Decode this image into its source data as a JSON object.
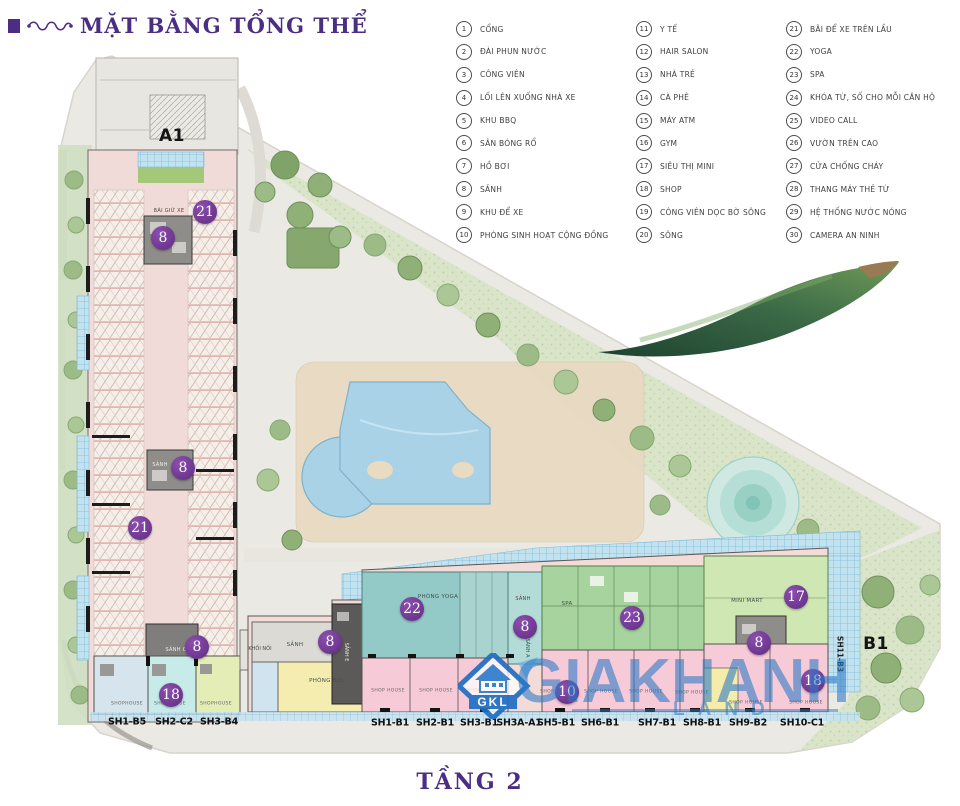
{
  "title": "MẶT BẰNG TỔNG THỂ",
  "floor_label": "TẦNG 2",
  "legend": {
    "columns": [
      {
        "items": [
          {
            "num": "1",
            "label": "CỔNG"
          },
          {
            "num": "2",
            "label": "ĐÀI PHUN NƯỚC"
          },
          {
            "num": "3",
            "label": "CÔNG VIÊN"
          },
          {
            "num": "4",
            "label": "LỐI LÊN XUỐNG NHÀ XE"
          },
          {
            "num": "5",
            "label": "KHU BBQ"
          },
          {
            "num": "6",
            "label": "SÂN BÓNG RỔ"
          },
          {
            "num": "7",
            "label": "HỒ BƠI"
          },
          {
            "num": "8",
            "label": "SẢNH"
          },
          {
            "num": "9",
            "label": "KHU ĐỂ XE"
          },
          {
            "num": "10",
            "label": "PHÒNG SINH HOẠT CỘNG ĐỒNG"
          }
        ]
      },
      {
        "items": [
          {
            "num": "11",
            "label": "Y TẾ"
          },
          {
            "num": "12",
            "label": "HAIR SALON"
          },
          {
            "num": "13",
            "label": "NHÀ TRẺ"
          },
          {
            "num": "14",
            "label": "CÀ PHÊ"
          },
          {
            "num": "15",
            "label": "MÁY ATM"
          },
          {
            "num": "16",
            "label": "GYM"
          },
          {
            "num": "17",
            "label": "SIÊU THỊ MINI"
          },
          {
            "num": "18",
            "label": "SHOP"
          },
          {
            "num": "19",
            "label": "CÔNG VIÊN DỌC BỜ SÔNG"
          },
          {
            "num": "20",
            "label": "SÔNG"
          }
        ]
      },
      {
        "items": [
          {
            "num": "21",
            "label": "BÃI ĐỂ XE TRÊN LẦU"
          },
          {
            "num": "22",
            "label": "YOGA"
          },
          {
            "num": "23",
            "label": "SPA"
          },
          {
            "num": "24",
            "label": "KHÓA TỪ, SỐ CHO MỖI CĂN HỘ"
          },
          {
            "num": "25",
            "label": "VIDEO CALL"
          },
          {
            "num": "26",
            "label": "VƯỜN TRÊN CAO"
          },
          {
            "num": "27",
            "label": "CỬA CHỐNG CHÁY"
          },
          {
            "num": "28",
            "label": "THANG MÁY THẺ TỪ"
          },
          {
            "num": "29",
            "label": "HỆ THỐNG NƯỚC NÓNG"
          },
          {
            "num": "30",
            "label": "CAMERA AN NINH"
          }
        ]
      }
    ]
  },
  "plan": {
    "building_labels": [
      {
        "text": "A1",
        "x": 172,
        "y": 136
      },
      {
        "text": "B1",
        "x": 876,
        "y": 644
      }
    ],
    "badges": [
      {
        "num": "21",
        "x": 205,
        "y": 212
      },
      {
        "num": "8",
        "x": 163,
        "y": 238
      },
      {
        "num": "8",
        "x": 183,
        "y": 468
      },
      {
        "num": "21",
        "x": 140,
        "y": 528
      },
      {
        "num": "8",
        "x": 197,
        "y": 647
      },
      {
        "num": "18",
        "x": 171,
        "y": 695
      },
      {
        "num": "22",
        "x": 412,
        "y": 609
      },
      {
        "num": "8",
        "x": 330,
        "y": 642
      },
      {
        "num": "8",
        "x": 525,
        "y": 627
      },
      {
        "num": "23",
        "x": 632,
        "y": 618
      },
      {
        "num": "10",
        "x": 567,
        "y": 692
      },
      {
        "num": "17",
        "x": 796,
        "y": 597
      },
      {
        "num": "8",
        "x": 759,
        "y": 643
      },
      {
        "num": "18",
        "x": 813,
        "y": 681
      }
    ],
    "room_labels": [
      {
        "text": "BÃI GIỮ XE",
        "x": 169,
        "y": 211,
        "style": "rl-d5"
      },
      {
        "text": "SẢNH",
        "x": 160,
        "y": 465,
        "style": "rl-w"
      },
      {
        "text": "SẢNH C",
        "x": 176,
        "y": 650,
        "style": "rl-w"
      },
      {
        "text": "KHỐI NỐI",
        "x": 260,
        "y": 649,
        "style": "rl-wrap"
      },
      {
        "text": "SẢNH",
        "x": 295,
        "y": 645,
        "style": "rl-d6"
      },
      {
        "text": "PHÒNG BQL",
        "x": 327,
        "y": 681,
        "style": "rl-d6"
      },
      {
        "text": "PHÒNG YOGA",
        "x": 438,
        "y": 597,
        "style": "rl-d6"
      },
      {
        "text": "SẢNH",
        "x": 523,
        "y": 599,
        "style": "rl-d5"
      },
      {
        "text": "SPA",
        "x": 567,
        "y": 604,
        "style": "rl-d6"
      },
      {
        "text": "MINI MART",
        "x": 747,
        "y": 601,
        "style": "rl-d6"
      }
    ],
    "vertical_labels": [
      {
        "text": "SẢNH E",
        "x": 346,
        "y": 652,
        "style": "vl-w"
      },
      {
        "text": "SẢNH A",
        "x": 527,
        "y": 648,
        "style": "vl-d"
      },
      {
        "text": "SH11-B3",
        "x": 840,
        "y": 654,
        "style": "vl-b"
      }
    ],
    "unit_labels": [
      {
        "text": "SH1-B5",
        "x": 127,
        "y": 722
      },
      {
        "text": "SH2-C2",
        "x": 174,
        "y": 722
      },
      {
        "text": "SH3-B4",
        "x": 219,
        "y": 722
      },
      {
        "text": "SH1-B1",
        "x": 390,
        "y": 723
      },
      {
        "text": "SH2-B1",
        "x": 435,
        "y": 723
      },
      {
        "text": "SH3-B1",
        "x": 479,
        "y": 723
      },
      {
        "text": "SH3A-A1",
        "x": 519,
        "y": 723
      },
      {
        "text": "SH5-B1",
        "x": 556,
        "y": 723
      },
      {
        "text": "SH6-B1",
        "x": 600,
        "y": 723
      },
      {
        "text": "SH7-B1",
        "x": 657,
        "y": 723
      },
      {
        "text": "SH8-B1",
        "x": 702,
        "y": 723
      },
      {
        "text": "SH9-B2",
        "x": 748,
        "y": 723
      },
      {
        "text": "SH10-C1",
        "x": 802,
        "y": 723
      }
    ],
    "shophouse_labels": [
      {
        "text": "SHOPHOUSE",
        "x": 127,
        "y": 704
      },
      {
        "text": "SHOPHOUSE",
        "x": 170,
        "y": 704
      },
      {
        "text": "SHOPHOUSE",
        "x": 216,
        "y": 704
      },
      {
        "text": "SHOP HOUSE",
        "x": 388,
        "y": 691
      },
      {
        "text": "SHOP HOUSE",
        "x": 436,
        "y": 691
      },
      {
        "text": "SHOP HOUSE",
        "x": 484,
        "y": 691
      },
      {
        "text": "SHOP HOUSE",
        "x": 557,
        "y": 692
      },
      {
        "text": "SHOP HOUSE",
        "x": 601,
        "y": 692
      },
      {
        "text": "SHOP HOUSE",
        "x": 646,
        "y": 692
      },
      {
        "text": "SHOP HOUSE",
        "x": 692,
        "y": 693
      },
      {
        "text": "SHOP HOUSE",
        "x": 746,
        "y": 703
      },
      {
        "text": "SHOP HOUSE",
        "x": 806,
        "y": 703
      }
    ]
  },
  "watermark": {
    "logo": "GKL",
    "name": "GIAKHANH",
    "sub": "LAND"
  },
  "colors": {
    "title_purple": "#4b2e84",
    "badge_purple": "#6e3693",
    "watermark_blue": "#2b7cc9",
    "building_pink": "#f1dbd8",
    "yoga_teal": "#93c9c6",
    "spa_green": "#a6d39e",
    "minimart_green": "#cfe7b2",
    "shophouse_pink": "#f6cbd7",
    "pool_blue": "#a9d2e6"
  }
}
